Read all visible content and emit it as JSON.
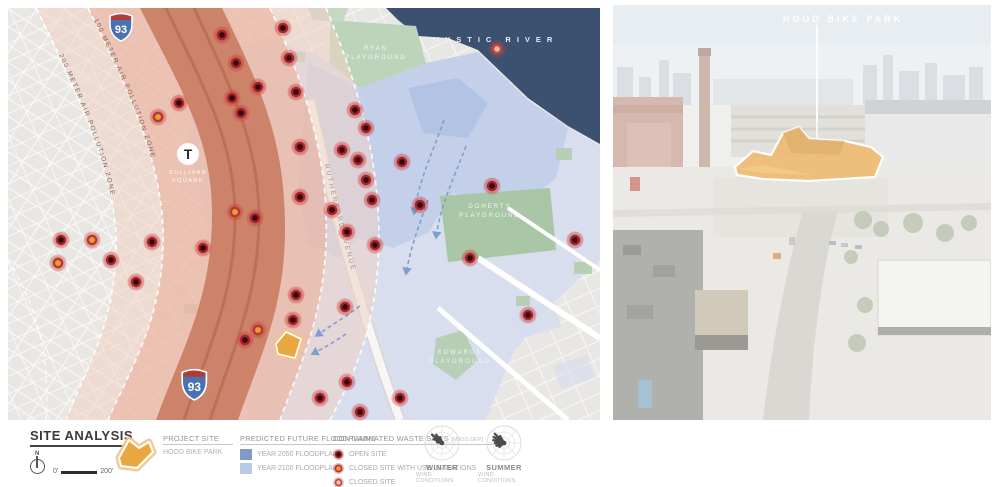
{
  "map": {
    "labels": {
      "river": "MYSTIC RIVER",
      "ryan_1": "RYAN",
      "ryan_2": "PLAYGROUND",
      "doherty_1": "DOHERTY",
      "doherty_2": "PLAYGROUND",
      "edwards_1": "EDWARDS",
      "edwards_2": "PLAYGROUND",
      "rutherford": "RUTHERFORD AVENUE",
      "zone_100": "100 METER AIR POLLUTION ZONE",
      "zone_200": "200 METER AIR POLLUTION ZONE",
      "station_1": "SULLIVAN",
      "station_2": "SQUARE",
      "t_logo": "T",
      "interstate": "93"
    },
    "colors": {
      "river": "#3c5170",
      "floodplain_2050": "#bfcce9",
      "floodplain_2100": "#d5dcef",
      "highway_core": "#c97e63",
      "pollution_mid": "#e9b19c",
      "pollution_outer": "#f1d2c5",
      "park_green": "#b7d0b5",
      "site_orange": "#e9a83f",
      "arrow_blue": "#7f9fd1"
    },
    "waste_sites": [
      [
        214,
        27,
        "o"
      ],
      [
        275,
        20,
        "o"
      ],
      [
        228,
        55,
        "o"
      ],
      [
        281,
        50,
        "o"
      ],
      [
        250,
        79,
        "o"
      ],
      [
        224,
        90,
        "o"
      ],
      [
        288,
        84,
        "o"
      ],
      [
        150,
        109,
        "l"
      ],
      [
        233,
        105,
        "o"
      ],
      [
        347,
        102,
        "o"
      ],
      [
        358,
        120,
        "o"
      ],
      [
        334,
        142,
        "o"
      ],
      [
        292,
        139,
        "o"
      ],
      [
        350,
        152,
        "o"
      ],
      [
        394,
        154,
        "o"
      ],
      [
        484,
        178,
        "o"
      ],
      [
        358,
        172,
        "o"
      ],
      [
        412,
        197,
        "o"
      ],
      [
        364,
        192,
        "o"
      ],
      [
        324,
        202,
        "o"
      ],
      [
        292,
        189,
        "o"
      ],
      [
        247,
        210,
        "o"
      ],
      [
        227,
        204,
        "l"
      ],
      [
        144,
        234,
        "o"
      ],
      [
        84,
        232,
        "l"
      ],
      [
        53,
        232,
        "o"
      ],
      [
        103,
        252,
        "o"
      ],
      [
        50,
        255,
        "l"
      ],
      [
        128,
        274,
        "o"
      ],
      [
        339,
        224,
        "o"
      ],
      [
        367,
        237,
        "o"
      ],
      [
        567,
        232,
        "o"
      ],
      [
        462,
        250,
        "o"
      ],
      [
        288,
        287,
        "o"
      ],
      [
        337,
        299,
        "o"
      ],
      [
        520,
        307,
        "o"
      ],
      [
        285,
        312,
        "o"
      ],
      [
        250,
        322,
        "l"
      ],
      [
        237,
        332,
        "o"
      ],
      [
        339,
        374,
        "o"
      ],
      [
        392,
        390,
        "o"
      ],
      [
        312,
        390,
        "o"
      ],
      [
        352,
        404,
        "o"
      ],
      [
        195,
        240,
        "o"
      ],
      [
        171,
        95,
        "o"
      ],
      [
        489,
        41,
        "c"
      ]
    ]
  },
  "aerial": {
    "site_label": "HOOD BIKE PARK"
  },
  "legend": {
    "title": "SITE ANALYSIS",
    "north": "N",
    "scale_start": "0'",
    "scale_end": "200'",
    "project": {
      "heading": "PROJECT SITE",
      "name": "HOOD BIKE PARK"
    },
    "floodplains": {
      "heading": "PREDICTED FUTURE FLOODPLAINS",
      "items": [
        {
          "label": "YEAR 2050 FLOODPLAIN",
          "color": "#7e9ac9"
        },
        {
          "label": "YEAR 2100 FLOODPLAIN",
          "color": "#b9c8e5"
        }
      ]
    },
    "waste": {
      "heading": "CONTAMINATED WASTE SITES",
      "source": "(MASS DEP)",
      "items": [
        {
          "label": "OPEN SITE",
          "type": "o"
        },
        {
          "label": "CLOSED SITE WITH USE LIMITATIONS",
          "type": "l"
        },
        {
          "label": "CLOSED SITE",
          "type": "c"
        }
      ]
    },
    "wind": [
      {
        "name": "WINTER",
        "sub": "WIND CONDITIONS",
        "petals": [
          [
            310,
            13
          ],
          [
            325,
            10
          ],
          [
            295,
            9
          ],
          [
            340,
            6
          ],
          [
            280,
            5
          ]
        ]
      },
      {
        "name": "SUMMER",
        "sub": "WIND CONDITIONS",
        "petals": [
          [
            315,
            13
          ],
          [
            300,
            12
          ],
          [
            285,
            11
          ],
          [
            270,
            9
          ],
          [
            250,
            8
          ],
          [
            330,
            8
          ],
          [
            230,
            6
          ]
        ]
      }
    ]
  }
}
